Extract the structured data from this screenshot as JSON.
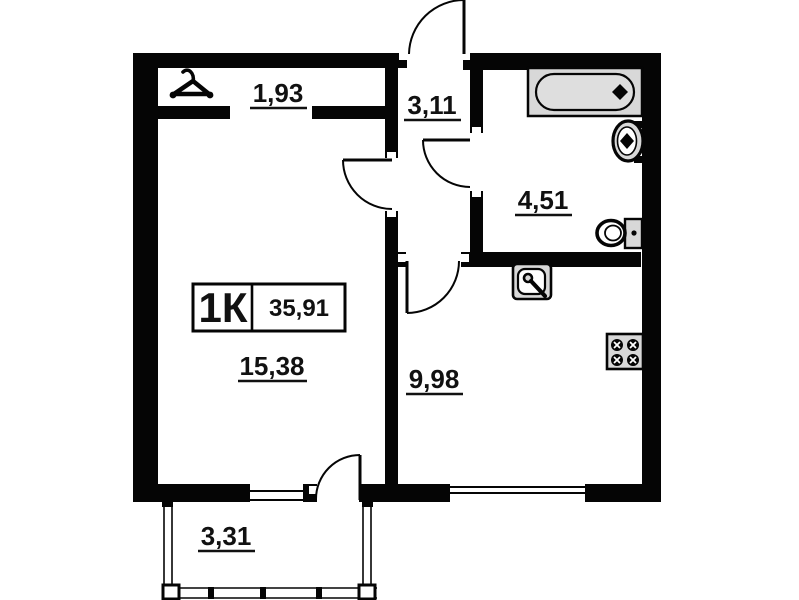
{
  "badge": {
    "type_label": "1К",
    "total_area": "35,91"
  },
  "rooms": {
    "closet": {
      "area": "1,93"
    },
    "hallway": {
      "area": "3,11"
    },
    "bathroom": {
      "area": "4,51"
    },
    "living_room": {
      "area": "15,38"
    },
    "kitchen": {
      "area": "9,98"
    },
    "balcony": {
      "area": "3,31"
    }
  },
  "fixtures": {
    "hanger": "hanger-icon",
    "bathtub": "bathtub-icon",
    "washbasin": "washbasin-icon",
    "toilet": "toilet-icon",
    "kitchen_sink": "kitchen-sink-icon",
    "stove": "stove-icon"
  },
  "colors": {
    "wall": "#050505",
    "fixture_fill": "#d8d8d8",
    "background": "#ffffff"
  }
}
